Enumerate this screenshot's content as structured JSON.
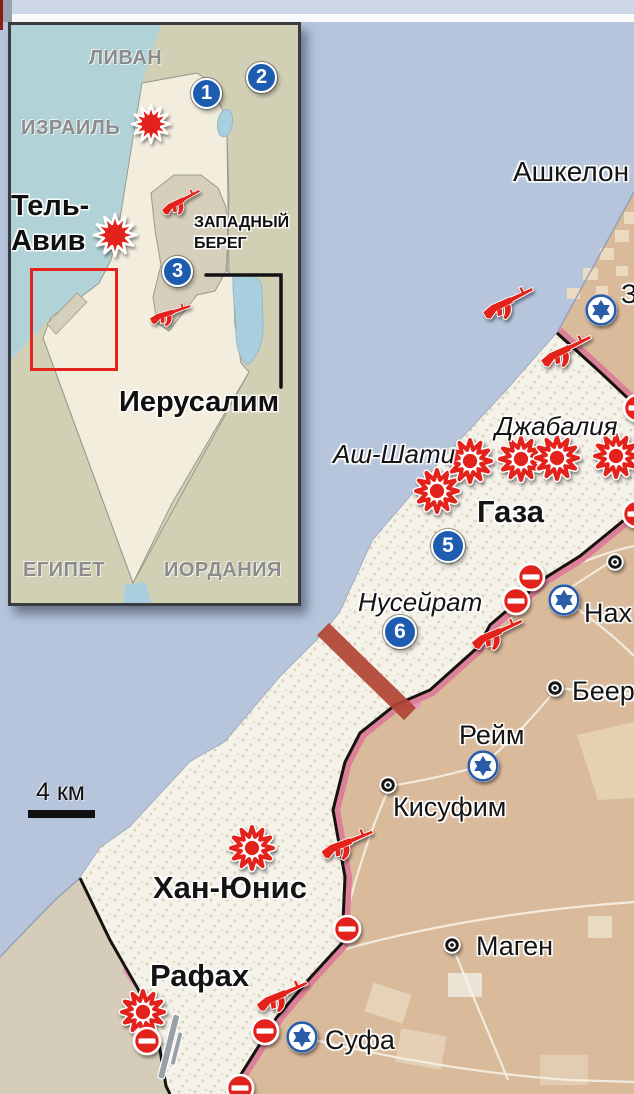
{
  "title": "Карта сектора Газа — инфографика",
  "inset": {
    "labels": {
      "lebanon": "ЛИВАН",
      "israel": "ИЗРАИЛЬ",
      "tel_aviv_line1": "Тель-",
      "tel_aviv_line2": "Авив",
      "west_bank_line1": "ЗАПАДНЫЙ",
      "west_bank_line2": "БЕРЕГ",
      "jerusalem": "Иерусалим",
      "egypt": "ЕГИПЕТ",
      "jordan": "ИОРДАНИЯ"
    },
    "numbered_markers": [
      "1",
      "2",
      "3"
    ]
  },
  "main_map": {
    "labels": {
      "ashkelon": "Ашкелон",
      "zikim_partial": "З",
      "jabalia": "Джабалия",
      "ash_shati": "Аш-Шати",
      "gaza": "Газа",
      "nuseirat": "Нусейрат",
      "nahal_partial": "Нах",
      "beeri_partial": "Беер",
      "reim": "Рейм",
      "kisufim": "Кисуфим",
      "khan_yunis": "Хан-Юнис",
      "magen": "Маген",
      "rafah": "Рафах",
      "sufa": "Суфа"
    },
    "numbered_markers": [
      "5",
      "6"
    ],
    "scale_label": "4 км"
  },
  "icons": {
    "burst": "explosion-strike starburst",
    "rifle": "armed-attack rifle silhouette",
    "no_entry": "closed-crossing sign",
    "star_of_david": "israeli-army position",
    "town_dot": "settlement marker",
    "corridor_band": "blocked corridor across strip"
  },
  "colors": {
    "sea": "#b6c5dc",
    "inset_sea": "#b1d2d7",
    "israel_land": "#d9ba9b",
    "egypt_land": "#d5ccb9",
    "gaza_fill": "#f5f2e9",
    "neighbor_land": "#d1d0b5",
    "israel_inset": "#f2eddd",
    "accent_red": "#e3241d",
    "border_pink": "#dc7f98",
    "corridor_red": "#b14434",
    "marker_blue": "#1e5caf",
    "star_blue": "#2a5ca8",
    "urban_pink": "#e49ab8"
  }
}
